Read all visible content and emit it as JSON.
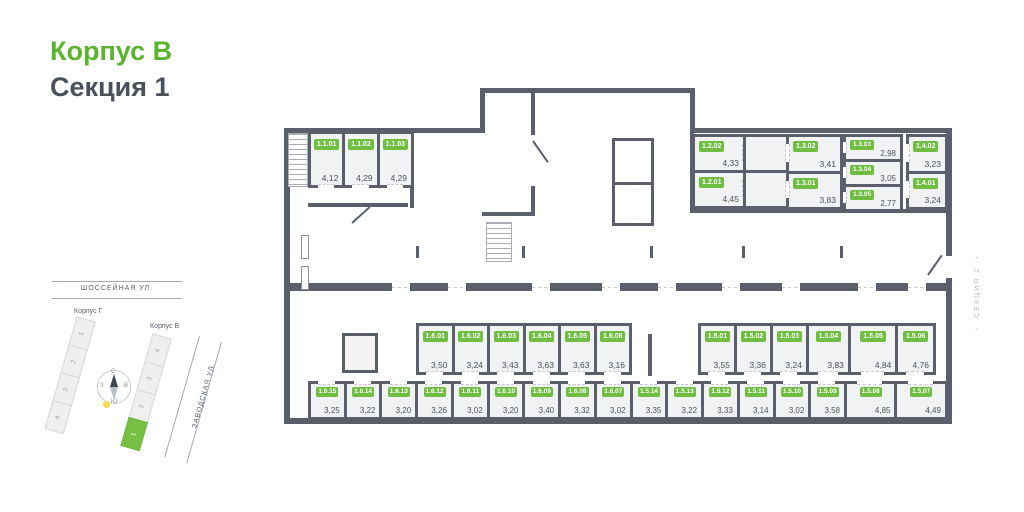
{
  "title": {
    "building": "Корпус В",
    "section": "Секция 1"
  },
  "colors": {
    "accent_green": "#5bb42e",
    "badge_green": "#6fbe41",
    "wall": "#5a5f6b",
    "room_fill": "#f1f2f3",
    "text_dark": "#4a505c",
    "highlight_section": "#76c043",
    "sun_yellow": "#f7d84a"
  },
  "section2": {
    "label": "СЕКЦИЯ 2",
    "arrow_left": "‹",
    "arrow_right": "›"
  },
  "minimap": {
    "street_top": "ШОССЕЙНАЯ УЛ.",
    "street_right": "ЗАВОДСКАЯ УЛ.",
    "korpus_g": "Корпус Г",
    "korpus_v": "Корпус В",
    "strip_g": [
      "1",
      "2",
      "3",
      "4"
    ],
    "strip_v": [
      "4",
      "3",
      "2",
      "1"
    ],
    "highlighted_section": "1",
    "compass": {
      "n": "С",
      "e": "В",
      "s": "Ю",
      "w": "З"
    }
  },
  "rooms": {
    "group_1_1": [
      {
        "id": "1.1.01",
        "area": "4,12"
      },
      {
        "id": "1.1.02",
        "area": "4,29"
      },
      {
        "id": "1.1.03",
        "area": "4,29"
      }
    ],
    "group_1_2": [
      {
        "id": "1.2.02",
        "area": "4,33"
      },
      {
        "id": "1.2.01",
        "area": "4,45"
      }
    ],
    "group_1_3_a": [
      {
        "id": "1.3.02",
        "area": "3,41"
      },
      {
        "id": "1.3.01",
        "area": "3,83"
      }
    ],
    "group_1_3_b": [
      {
        "id": "1.3.03",
        "area": "2,98"
      },
      {
        "id": "1.3.04",
        "area": "3,05"
      },
      {
        "id": "1.3.05",
        "area": "2,77"
      }
    ],
    "group_1_4": [
      {
        "id": "1.4.02",
        "area": "3,23"
      },
      {
        "id": "1.4.01",
        "area": "3,24"
      }
    ],
    "group_1_6_upper": [
      {
        "id": "1.6.01",
        "area": "3,50"
      },
      {
        "id": "1.6.02",
        "area": "3,24"
      },
      {
        "id": "1.6.03",
        "area": "3,43"
      },
      {
        "id": "1.6.04",
        "area": "3,63"
      },
      {
        "id": "1.6.05",
        "area": "3,63"
      },
      {
        "id": "1.6.06",
        "area": "3,16"
      }
    ],
    "group_1_5_upper": [
      {
        "id": "1.5.01",
        "area": "3,55"
      },
      {
        "id": "1.5.02",
        "area": "3,36"
      },
      {
        "id": "1.5.03",
        "area": "3,24"
      },
      {
        "id": "1.5.04",
        "area": "3,83"
      },
      {
        "id": "1.5.05",
        "area": "4,84"
      },
      {
        "id": "1.5.06",
        "area": "4,76"
      }
    ],
    "group_bottom": [
      {
        "id": "1.6.15",
        "area": "3,25"
      },
      {
        "id": "1.6.14",
        "area": "3,22"
      },
      {
        "id": "1.6.13",
        "area": "3,20"
      },
      {
        "id": "1.6.12",
        "area": "3,26"
      },
      {
        "id": "1.6.11",
        "area": "3,02"
      },
      {
        "id": "1.6.10",
        "area": "3,20"
      },
      {
        "id": "1.6.09",
        "area": "3,40"
      },
      {
        "id": "1.6.08",
        "area": "3,32"
      },
      {
        "id": "1.6.07",
        "area": "3,02"
      },
      {
        "id": "1.5.14",
        "area": "3,35"
      },
      {
        "id": "1.5.13",
        "area": "3,22"
      },
      {
        "id": "1.5.12",
        "area": "3,33"
      },
      {
        "id": "1.5.11",
        "area": "3,14"
      },
      {
        "id": "1.5.10",
        "area": "3,02"
      },
      {
        "id": "1.5.09",
        "area": "3,58"
      },
      {
        "id": "1.5.08",
        "area": "4,85"
      },
      {
        "id": "1.5.07",
        "area": "4,49"
      }
    ]
  }
}
